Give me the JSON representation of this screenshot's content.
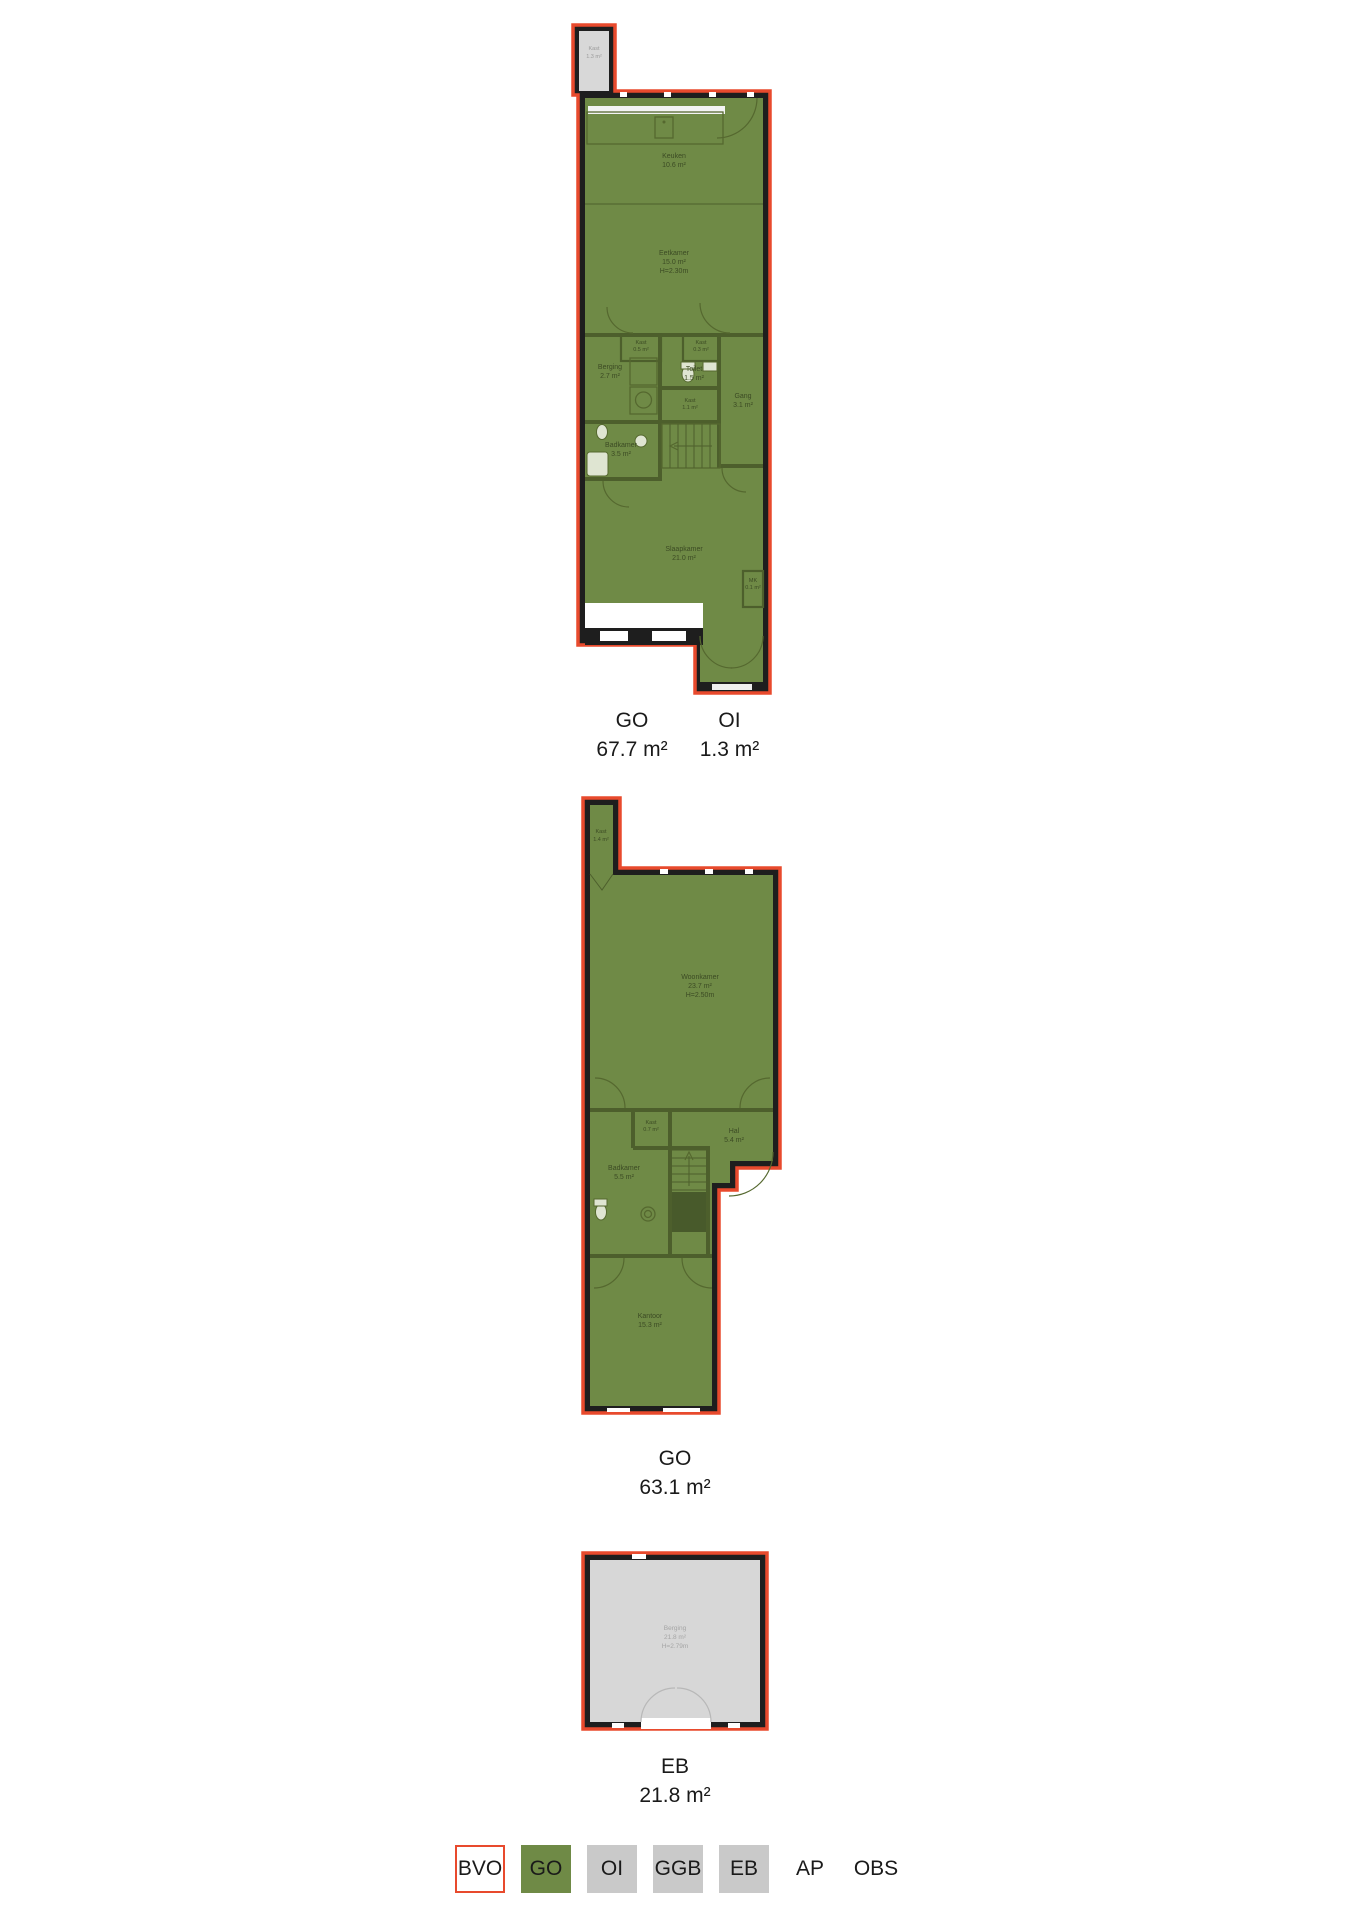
{
  "colors": {
    "go_green": "#6f8a46",
    "eb_gray": "#d7d7d7",
    "legend_gray": "#c9c9c9",
    "outline_red": "#e84a2d",
    "wall_dark": "#1e1e1e"
  },
  "plans": [
    {
      "name": "floor-1",
      "rooms": [
        {
          "name": "Kast",
          "area": "1.3 m²"
        },
        {
          "name": "Keuken",
          "area": "10.6 m²"
        },
        {
          "name": "Eetkamer",
          "area": "15.0 m²",
          "height": "H=2.30m"
        },
        {
          "name": "Kast",
          "area": "0.5 m²"
        },
        {
          "name": "Kast",
          "area": "0.3 m²"
        },
        {
          "name": "Berging",
          "area": "2.7 m²"
        },
        {
          "name": "Toilet",
          "area": "1.5 m²"
        },
        {
          "name": "Gang",
          "area": "3.1 m²"
        },
        {
          "name": "Kast",
          "area": "1.1 m²"
        },
        {
          "name": "Badkamer",
          "area": "3.5 m²"
        },
        {
          "name": "Slaapkamer",
          "area": "21.0 m²"
        },
        {
          "name": "MK",
          "area": "0.1 m²"
        }
      ],
      "totals": [
        {
          "code": "GO",
          "area": "67.7 m²"
        },
        {
          "code": "OI",
          "area": "1.3 m²"
        }
      ]
    },
    {
      "name": "floor-2",
      "rooms": [
        {
          "name": "Kast",
          "area": "1.4 m²"
        },
        {
          "name": "Woonkamer",
          "area": "23.7 m²",
          "height": "H=2.50m"
        },
        {
          "name": "Kast",
          "area": "0.7 m²"
        },
        {
          "name": "Hal",
          "area": "5.4 m²"
        },
        {
          "name": "Badkamer",
          "area": "5.5 m²"
        },
        {
          "name": "Kantoor",
          "area": "15.3 m²"
        }
      ],
      "totals": [
        {
          "code": "GO",
          "area": "63.1 m²"
        }
      ]
    },
    {
      "name": "floor-3",
      "rooms": [
        {
          "name": "Berging",
          "area": "21.8 m²",
          "height": "H=2.79m"
        }
      ],
      "totals": [
        {
          "code": "EB",
          "area": "21.8 m²"
        }
      ]
    }
  ],
  "legend": {
    "items": [
      {
        "label": "BVO",
        "swatch": "outline-red"
      },
      {
        "label": "GO",
        "swatch": "green"
      },
      {
        "label": "OI",
        "swatch": "gray"
      },
      {
        "label": "GGB",
        "swatch": "gray"
      },
      {
        "label": "EB",
        "swatch": "gray"
      },
      {
        "label": "AP",
        "swatch": "none"
      },
      {
        "label": "OBS",
        "swatch": "none"
      }
    ]
  }
}
